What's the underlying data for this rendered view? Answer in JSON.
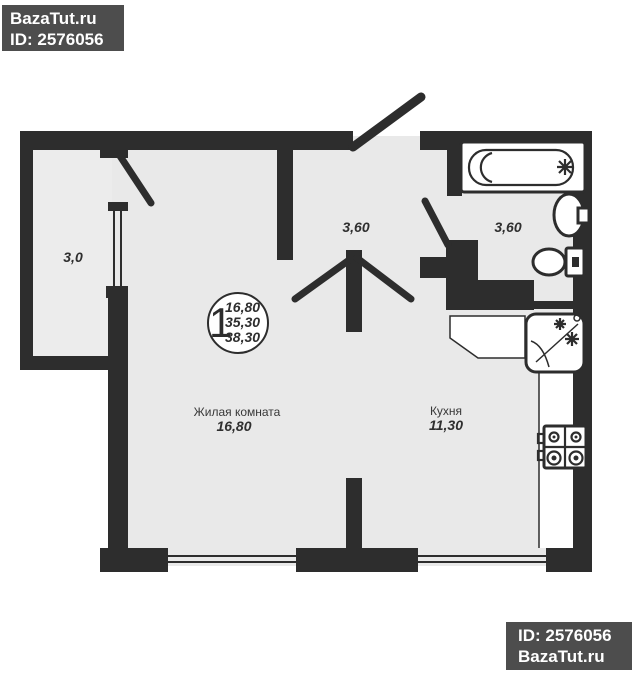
{
  "watermark_top": {
    "site": "BazaTut.ru",
    "id": "ID: 2576056"
  },
  "watermark_bottom": {
    "id": "ID: 2576056",
    "site": "BazaTut.ru"
  },
  "floorplan": {
    "summary_circle": {
      "rooms_count": "1",
      "living_area": "16,80",
      "apartment_area": "35,30",
      "total_area": "38,30"
    },
    "labels": {
      "living_room": {
        "name": "Жилая комната",
        "area": "16,80"
      },
      "kitchen": {
        "name": "Кухня",
        "area": "11,30"
      },
      "balcony": {
        "area": "3,0"
      },
      "hallway": {
        "area": "3,60"
      },
      "bathroom": {
        "area": "3,60"
      }
    },
    "colors": {
      "wall": "#2d2d2d",
      "floor": "#e9e9e9",
      "watermark_bg": "#4d4d4d",
      "watermark_text": "#ffffff"
    }
  }
}
